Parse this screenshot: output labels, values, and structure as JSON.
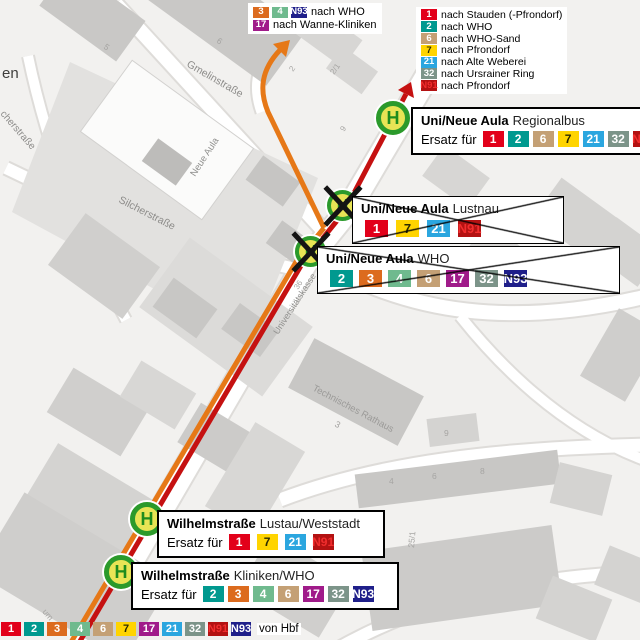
{
  "colors": {
    "route_red": "#C51111",
    "route_orange": "#E67817",
    "map_bg": "#F2F1EF",
    "stop_ring": "#2B9A2B",
    "stop_fill": "#E8E455"
  },
  "lines": {
    "1": {
      "bg": "#E2001A",
      "fg": "#FFFFFF"
    },
    "2": {
      "bg": "#00998F",
      "fg": "#FFFFFF"
    },
    "3": {
      "bg": "#DC6B1E",
      "fg": "#FFFFFF"
    },
    "4": {
      "bg": "#6FBA8E",
      "fg": "#FFFFFF"
    },
    "6": {
      "bg": "#C4A075",
      "fg": "#FFFFFF"
    },
    "7": {
      "bg": "#FFD400",
      "fg": "#2B2B00"
    },
    "17": {
      "bg": "#A01B8A",
      "fg": "#FFFFFF"
    },
    "21": {
      "bg": "#2BA6DF",
      "fg": "#FFFFFF"
    },
    "32": {
      "bg": "#7C9489",
      "fg": "#FFFFFF"
    },
    "N91": {
      "bg": "#B31212",
      "fg": "#F22E2E"
    },
    "N93": {
      "bg": "#1F1F8A",
      "fg": "#FFFFFF"
    }
  },
  "stop_letter": "H",
  "legend_top_left": {
    "rows": [
      {
        "badges": [
          "3",
          "4",
          "N93"
        ],
        "label": "nach WHO"
      },
      {
        "badges": [
          "17"
        ],
        "label": "nach Wanne-Kliniken"
      }
    ]
  },
  "legend_top_right": {
    "rows": [
      {
        "badges": [
          "1"
        ],
        "label": "nach Stauden (-Pfrondorf)"
      },
      {
        "badges": [
          "2"
        ],
        "label": "nach WHO"
      },
      {
        "badges": [
          "6"
        ],
        "label": "nach WHO-Sand"
      },
      {
        "badges": [
          "7"
        ],
        "label": "nach Pfrondorf"
      },
      {
        "badges": [
          "21"
        ],
        "label": "nach Alte Weberei"
      },
      {
        "badges": [
          "32"
        ],
        "label": "nach Ursrainer Ring"
      },
      {
        "badges": [
          "N91"
        ],
        "label": "nach Pfrondorf"
      }
    ]
  },
  "stops": {
    "regionalbus": {
      "name": "Uni/Neue Aula",
      "qualifier": "Regionalbus",
      "ersatz_label": "Ersatz für",
      "badges": [
        "1",
        "2",
        "6",
        "7",
        "21",
        "32",
        "N91"
      ]
    },
    "lustnau": {
      "name": "Uni/Neue Aula",
      "qualifier": "Lustnau",
      "badges": [
        "1",
        "7",
        "21",
        "N91"
      ]
    },
    "who": {
      "name": "Uni/Neue Aula",
      "qualifier": "WHO",
      "badges": [
        "2",
        "3",
        "4",
        "6",
        "17",
        "32",
        "N93"
      ]
    },
    "wilhelm_lustau": {
      "name": "Wilhelmstraße",
      "qualifier": "Lustau/Weststadt",
      "ersatz_label": "Ersatz für",
      "badges": [
        "1",
        "7",
        "21",
        "N91"
      ]
    },
    "wilhelm_kliniken": {
      "name": "Wilhelmstraße",
      "qualifier": "Kliniken/WHO",
      "ersatz_label": "Ersatz für",
      "badges": [
        "2",
        "3",
        "4",
        "6",
        "17",
        "32",
        "N93"
      ]
    }
  },
  "bottom_bar": {
    "badges": [
      "1",
      "2",
      "3",
      "4",
      "6",
      "7",
      "17",
      "21",
      "32",
      "N91",
      "N93"
    ],
    "label": "von Hbf"
  },
  "map_labels": {
    "gmelinstrasse": "Gmelinstraße",
    "silcherstrasse": "Silcherstraße",
    "cherstrasse": "cherstraße",
    "en": "en",
    "neue_aula": "Neue Aula",
    "unikasse": "Universitätskasse",
    "n36": "36",
    "rathaus": "Technisches Rathaus",
    "n3": "3",
    "n5": "5",
    "n6": "6",
    "n2": "2",
    "n21": "2/1",
    "n9": "9",
    "n9b": "9",
    "n4": "4",
    "n6b": "6",
    "n8": "8",
    "n251": "25/1",
    "um": "um"
  }
}
